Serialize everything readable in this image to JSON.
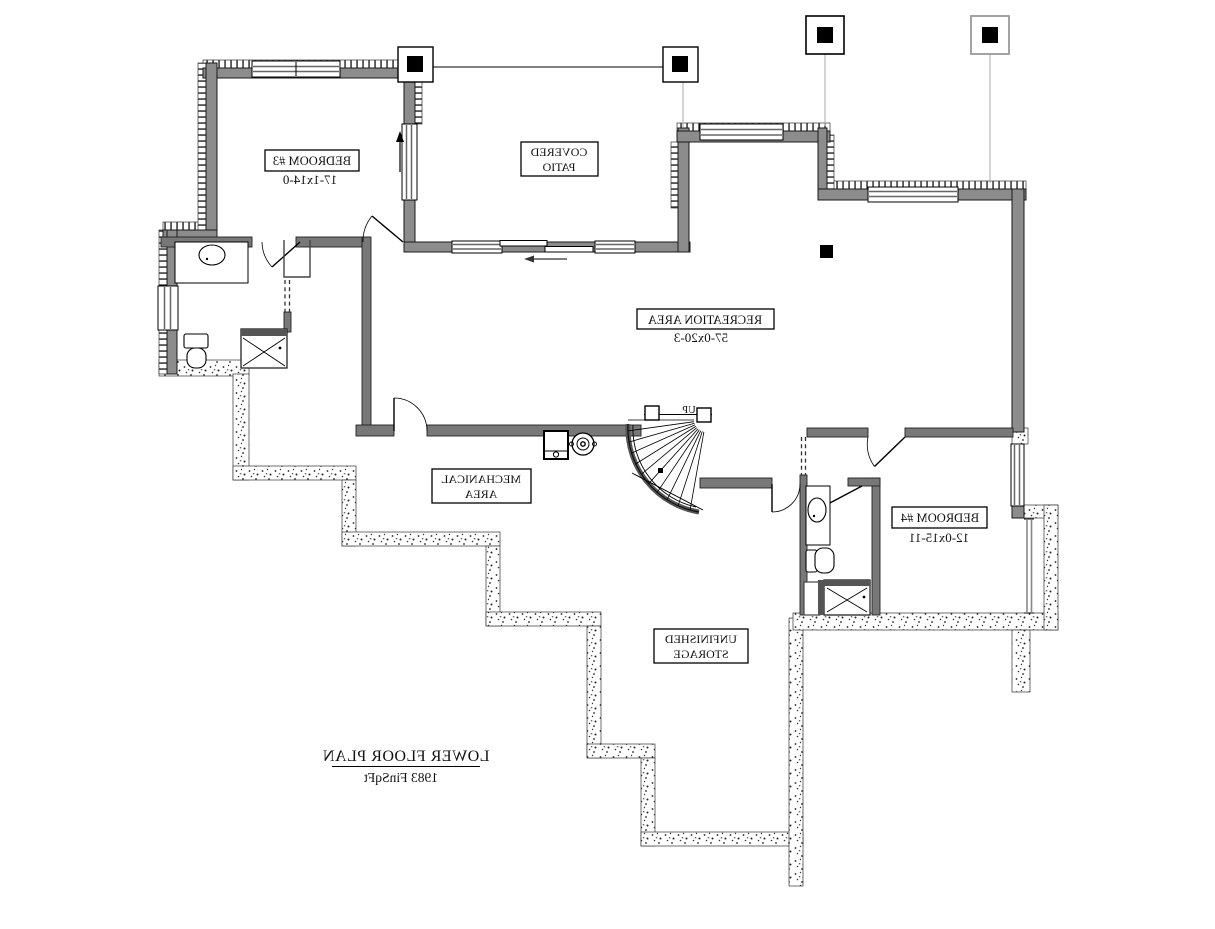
{
  "title_block": {
    "title": "LOWER FLOOR PLAN",
    "area": "1983 FinSqFt"
  },
  "rooms": {
    "bedroom3": {
      "name": "BEDROOM #3",
      "dims": "17-1x14-0"
    },
    "covered_patio": {
      "line1": "COVERED",
      "line2": "PATIO"
    },
    "recreation_area": {
      "name": "RECREATION AREA",
      "dims": "57-0x20-3"
    },
    "mechanical_area": {
      "line1": "MECHANICAL",
      "line2": "AREA"
    },
    "bedroom4": {
      "name": "BEDROOM #4",
      "dims": "12-0x15-11"
    },
    "unfinished_storage": {
      "line1": "UNFINISHED",
      "line2": "STORAGE"
    },
    "stair": {
      "label": "UP"
    }
  },
  "colors": {
    "exterior_wall": "#8c8c8c",
    "interior_wall": "#787878",
    "fixture_dark": "#555555",
    "line": "#000000",
    "background": "#ffffff"
  }
}
